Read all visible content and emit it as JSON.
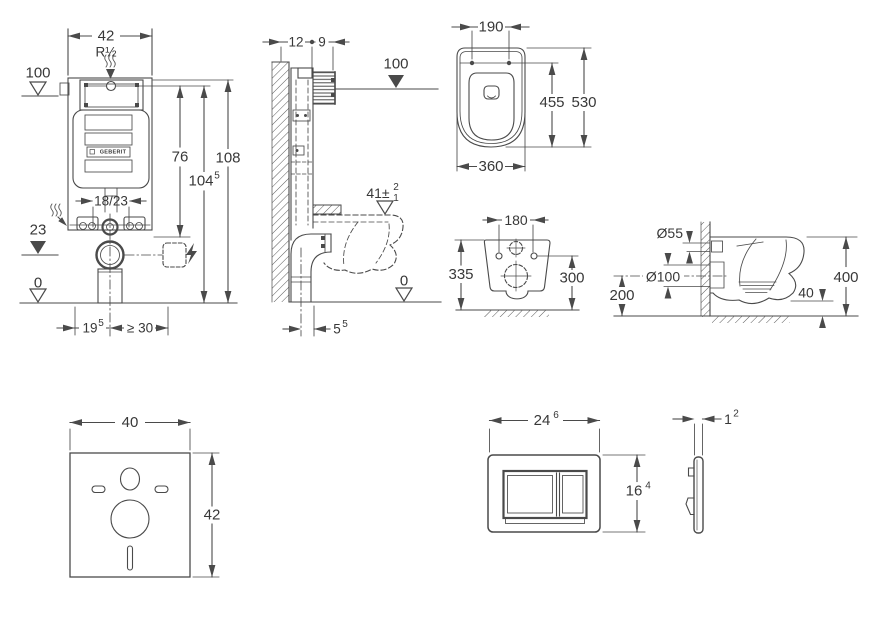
{
  "colors": {
    "line": "#4a4a4a",
    "text": "#383838",
    "background": "#ffffff"
  },
  "brand": "GEBERIT",
  "views": {
    "cistern_front": {
      "width": "42",
      "supply_thread": "R½",
      "level_top": "100",
      "height_flush": "76",
      "height_total": "108",
      "height_actuation": "104",
      "height_actuation_sup": "5",
      "bolt_spacing": "18/23",
      "level_mid": "23",
      "level_zero": "0",
      "offset_drain": "19",
      "offset_drain_sup": "5",
      "clearance": "≥ 30"
    },
    "cistern_side": {
      "depth_frame": "12",
      "depth_box": "9",
      "level_top": "100",
      "seat_height": "41±",
      "seat_tol_upper": "2",
      "seat_tol_lower": "1",
      "level_zero": "0",
      "outlet_offset": "5",
      "outlet_offset_sup": "5"
    },
    "wc_top": {
      "hole_spacing": "190",
      "depth_seat": "455",
      "depth_total": "530",
      "width": "360"
    },
    "wc_rear": {
      "hole_spacing": "180",
      "height_left": "335",
      "height_right": "300"
    },
    "wc_side": {
      "inlet": "Ø55",
      "outlet": "Ø100",
      "outlet_height": "200",
      "floor_gap": "40",
      "height": "400"
    },
    "insulation_mat": {
      "width": "40",
      "height": "42"
    },
    "flush_plate_front": {
      "width": "24",
      "width_sup": "6",
      "height": "16",
      "height_sup": "4"
    },
    "flush_plate_side": {
      "thickness": "1",
      "thickness_sup": "2"
    }
  }
}
